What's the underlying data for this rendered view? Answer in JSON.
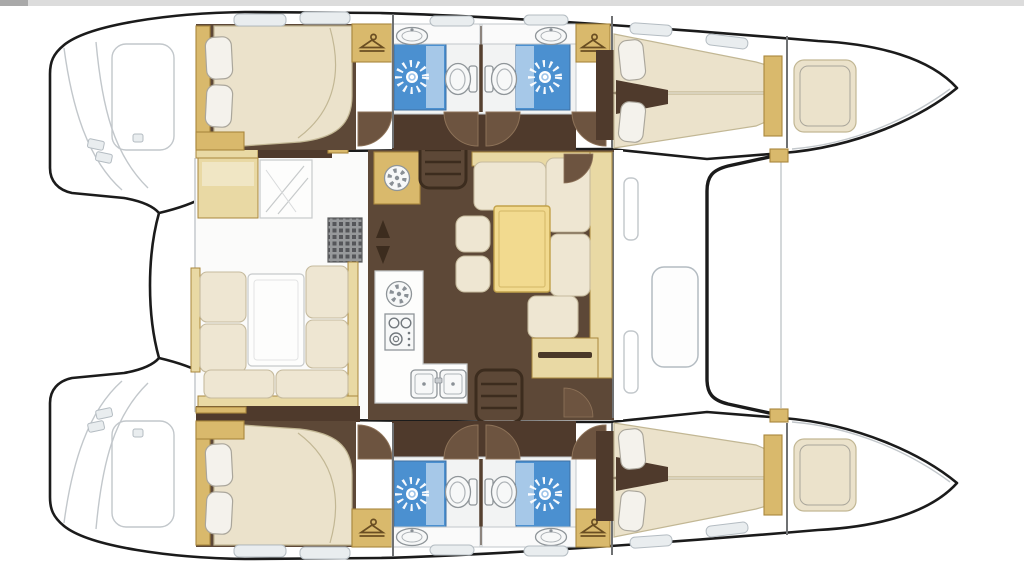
{
  "meta": {
    "title": "Catamaran sailing yacht accommodation floor plan",
    "view": "top-down deck plan",
    "orientation": "bows-right, twin hulls top and bottom, bridgedeck salon in center",
    "visible_text": []
  },
  "palette": {
    "hullOutline": "#1b1b1b",
    "lineGray": "#c2c7cb",
    "hatchFill": "#e9edef",
    "hatchEdge": "#b4bcc2",
    "cockpitFloor": "#fbfbfa",
    "floorBrown": "#5d4837",
    "corridorBrown": "#4f3a2c",
    "doorFill": "#6d5440",
    "doorEdge": "#8d7258",
    "cream": "#eee6d2",
    "creamEdge": "#c6bb9e",
    "mattress": "#ebe2cb",
    "mattressEdge": "#c2b794",
    "pillow": "#f4f2ec",
    "pillowEdge": "#aaa69b",
    "gold": "#d9b96c",
    "goldEdge": "#a9873d",
    "paleTan": "#e9d9a4",
    "tableYellow": "#f2da8f",
    "tableEdge": "#c2a24b",
    "showerBlue": "#4b90d0",
    "showerBlueLight": "#a6c8e8",
    "fixtureWhite": "#f7f8f8",
    "fixtureEdge": "#8f9599",
    "metalGray": "#767c81",
    "stepsBrown": "#3c2c1e",
    "bulkhead": "#6f7173",
    "grateBase": "#97999b",
    "grateDot": "#55565a",
    "topBar": "#dcdcdc",
    "topBarDark": "#a9a9a9",
    "sunRay": "#ffffff",
    "sunCenterRing": "#9cc3e9"
  },
  "layout_regions": {
    "port_hull_top": [
      "aft double cabin with pillows",
      "two back-to-back shower rooms",
      "forward v-berth cabin",
      "forepeak berth",
      "transom swim platform"
    ],
    "starboard_hull_bottom": [
      "aft double cabin with pillows",
      "two back-to-back shower rooms",
      "forward v-berth cabin",
      "forepeak berth",
      "transom swim platform"
    ],
    "bridgedeck": [
      "aft cockpit with U-settee and table",
      "chaise seat and bench",
      "galley with fan vent, hob, oven and twin sinks",
      "salon dinette with yellow table and ottomans",
      "nav seat and chart desk",
      "two companionway ladders",
      "foredeck lockers",
      "trampoline between bows"
    ]
  },
  "inventory": {
    "shower_sunburst_symbols": 4,
    "toilets": 4,
    "washbasins": 4,
    "wardrobe_hanger_icons": 4,
    "double_beds": 2,
    "v_berths": 2,
    "forepeak_berths": 2,
    "companionway_ladders": 2,
    "door_swing_arcs": 10,
    "deck_hatches": 12,
    "galley_twin_sinks": 1,
    "stove_burners": 3,
    "vent_fans": 2,
    "dinette_ottomans": 2,
    "cockpit_tables": 1,
    "dinette_tables": 1
  },
  "icons": {
    "shower": "sunburst-rays",
    "wardrobe": "clothes-hanger",
    "stove": "three-burner-hob",
    "galley_sink": "twin-basin",
    "vent": "fan-blades",
    "steps": "ladder-rungs",
    "mast_marker": "up-down-arrows"
  }
}
